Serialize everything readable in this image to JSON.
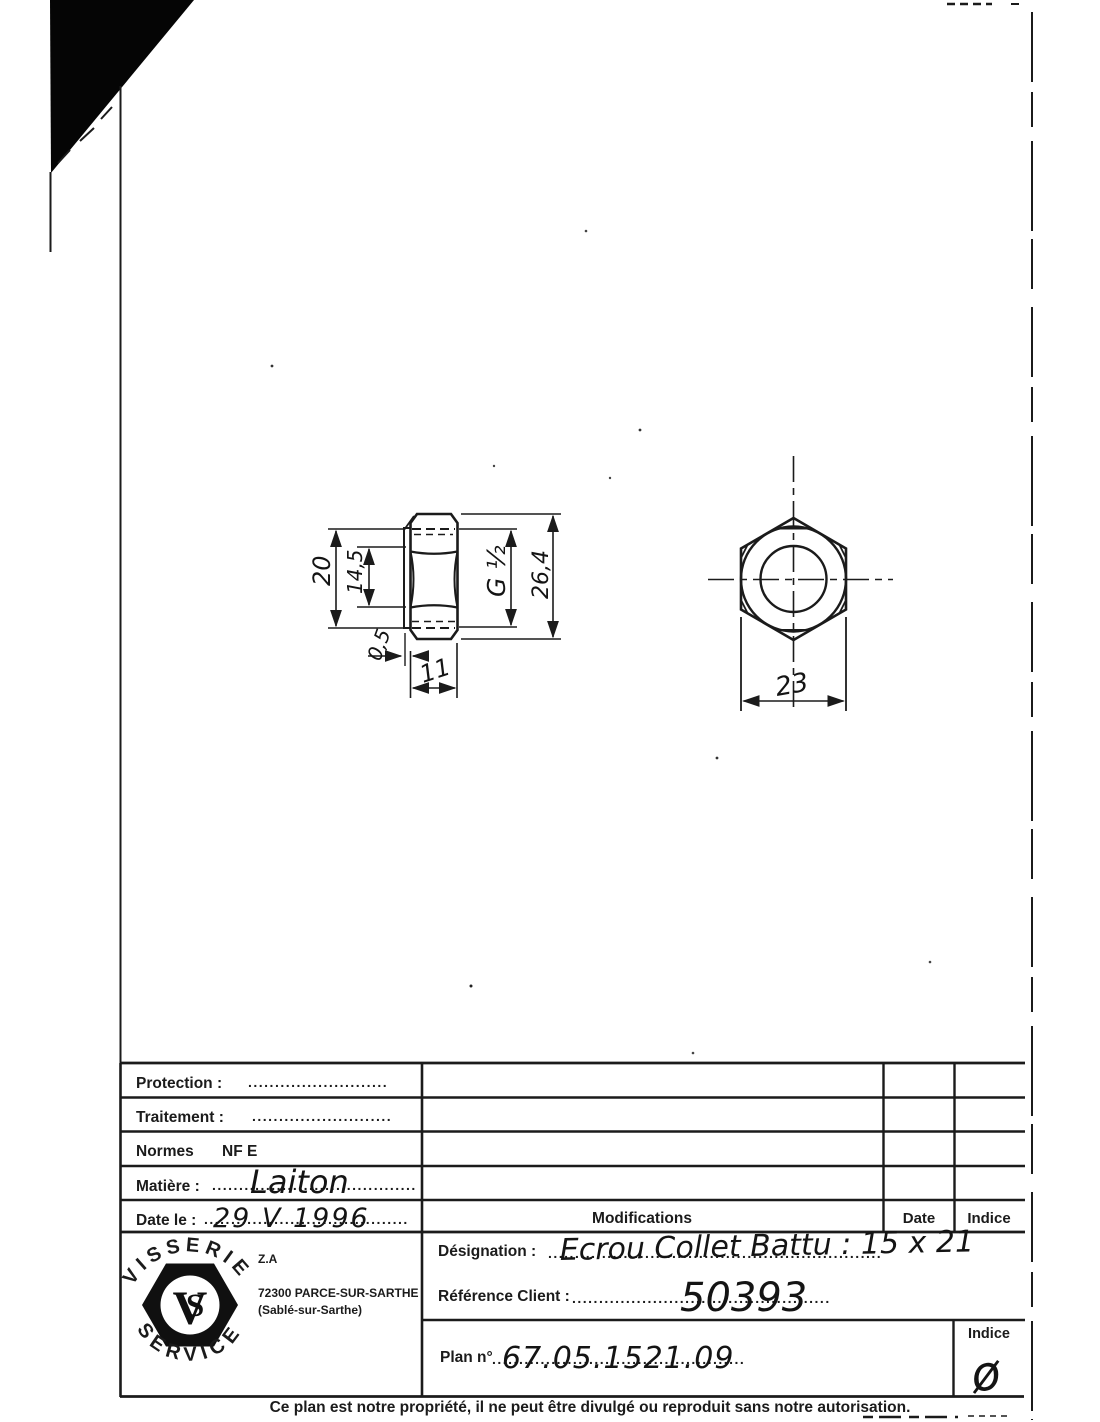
{
  "page": {
    "footer": "Ce plan est notre propriété, il ne peut être divulgé ou reproduit sans notre autorisation."
  },
  "drawing": {
    "side_view": {
      "dim_height": "20",
      "dim_bore": "14,5",
      "dim_thread": "G ½",
      "dim_across_corners": "26,4",
      "dim_flange": "0,5",
      "dim_width": "11"
    },
    "front_view": {
      "dim_across_flats": "23"
    }
  },
  "title_block": {
    "protection_label": "Protection :",
    "protection_dots": "..........................",
    "traitement_label": "Traitement :",
    "traitement_dots": "..........................",
    "normes_label": "Normes",
    "normes_value": "NF E",
    "matiere_label": "Matière :",
    "matiere_dots": "......................................",
    "matiere_value": "Laiton",
    "date_label": "Date le :",
    "date_dots": "......................................",
    "date_value": "29 V 1996",
    "modifications_header": "Modifications",
    "date_header": "Date",
    "indice_header": "Indice"
  },
  "designation": {
    "designation_label": "Désignation :",
    "designation_dots": "..............................................................",
    "designation_value": "Ecrou Collet Battu : 15 x 21",
    "reference_label": "Référence Client :",
    "reference_dots": "................................................",
    "reference_value": "50393",
    "plan_label": "Plan n°",
    "plan_dots": "...............................................",
    "plan_value": "67.05.1521.09",
    "indice_label": "Indice",
    "indice_value": "ø"
  },
  "company": {
    "arc_top": "VISSERIE",
    "arc_bottom": "SERVICE",
    "monogram_v": "V",
    "monogram_s": "S",
    "address1": "Z.A",
    "address2": "72300 PARCE-SUR-SARTHE",
    "address3": "(Sablé-sur-Sarthe)"
  }
}
